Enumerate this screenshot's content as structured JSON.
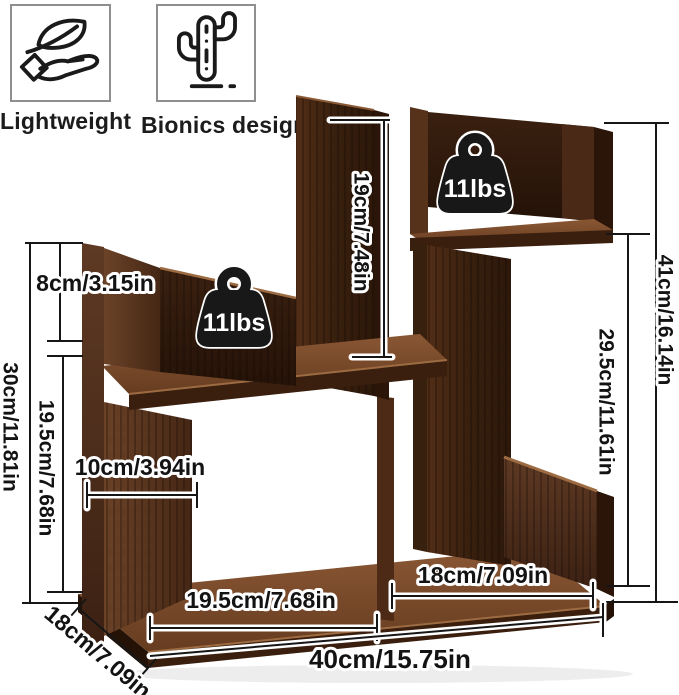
{
  "product": "desktop bookshelf dimension diagram",
  "features": [
    {
      "icon": "hand-leaf-icon",
      "label": "Lightweight"
    },
    {
      "icon": "cactus-icon",
      "label": "Bionics design"
    }
  ],
  "weight_badges": [
    "11lbs",
    "11lbs"
  ],
  "dimensions": [
    {
      "id": "upper-left-shelf-height",
      "value": "8cm/3.15in"
    },
    {
      "id": "left-total-height",
      "value": "30cm/11.81in"
    },
    {
      "id": "lower-left-interior-height",
      "value": "19.5cm/7.68in"
    },
    {
      "id": "lower-left-interior-width",
      "value": "10cm/3.94in"
    },
    {
      "id": "center-panel-height",
      "value": "19cm/7.48in"
    },
    {
      "id": "right-total-height",
      "value": "41cm/16.14in"
    },
    {
      "id": "right-interior-height",
      "value": "29.5cm/11.61in"
    },
    {
      "id": "bottom-left-opening-width",
      "value": "19.5cm/7.68in"
    },
    {
      "id": "bottom-right-opening-width",
      "value": "18cm/7.09in"
    },
    {
      "id": "total-width",
      "value": "40cm/15.75in"
    },
    {
      "id": "depth",
      "value": "18cm/7.09in"
    }
  ],
  "colors": {
    "wood_dark": "#2a1508",
    "wood_mid": "#53301a",
    "wood_light": "#8a5734",
    "line": "#161616",
    "badge": "#181818"
  }
}
